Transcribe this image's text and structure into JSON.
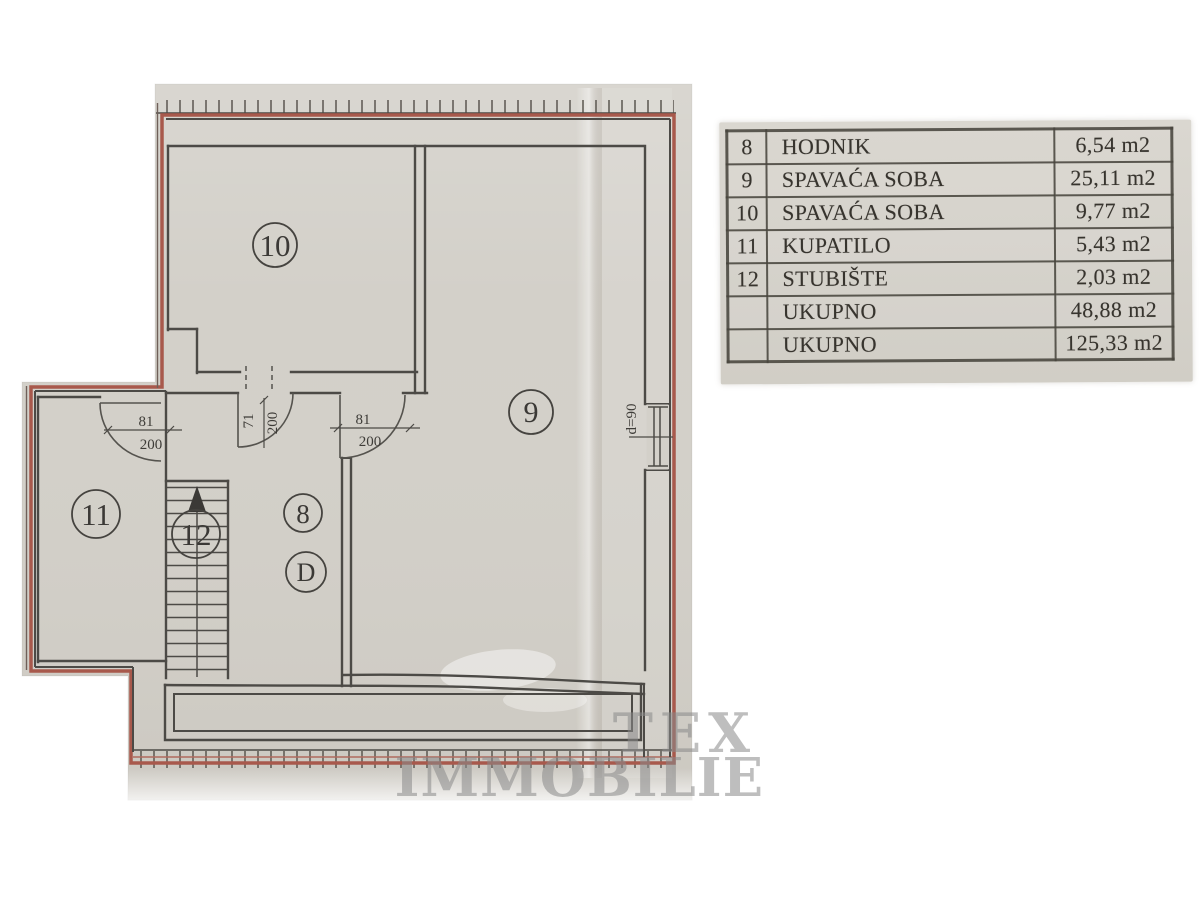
{
  "colors": {
    "paper": "#d3d0c9",
    "wall": "#4c4a46",
    "outline": "#a8594c",
    "ink": "#37342e",
    "watermark": "#8a8a8a"
  },
  "floor_plan": {
    "rooms": [
      {
        "id": "10",
        "label": "10"
      },
      {
        "id": "9",
        "label": "9"
      },
      {
        "id": "11",
        "label": "11"
      },
      {
        "id": "12",
        "label": "12"
      },
      {
        "id": "8",
        "label": "8"
      },
      {
        "id": "D",
        "label": "D"
      }
    ],
    "door_dims": [
      {
        "width": "81",
        "height": "200"
      },
      {
        "width": "71",
        "height": "200"
      },
      {
        "width": "81",
        "height": "200"
      }
    ],
    "window_dim": "d=90"
  },
  "legend_table": {
    "rows": [
      {
        "num": "8",
        "name": "HODNIK",
        "area": "6,54 m2"
      },
      {
        "num": "9",
        "name": "SPAVAĆA SOBA",
        "area": "25,11 m2"
      },
      {
        "num": "10",
        "name": "SPAVAĆA SOBA",
        "area": "9,77 m2"
      },
      {
        "num": "11",
        "name": "KUPATILO",
        "area": "5,43 m2"
      },
      {
        "num": "12",
        "name": "STUBIŠTE",
        "area": "2,03 m2"
      },
      {
        "num": "",
        "name": "UKUPNO",
        "area": "48,88 m2"
      },
      {
        "num": "",
        "name": "UKUPNO",
        "area": "125,33 m2"
      }
    ]
  },
  "watermark": {
    "line1": "TEX",
    "line2": "IMMOBILIE"
  }
}
